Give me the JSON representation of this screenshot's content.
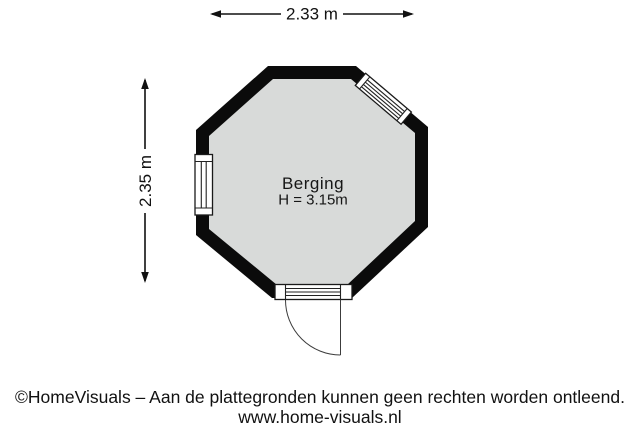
{
  "dimensions": {
    "width_label": "2.33 m",
    "height_label": "2.35 m"
  },
  "room": {
    "name": "Berging",
    "ceiling_height_label": "H = 3.15m"
  },
  "footer": {
    "line1": "©HomeVisuals – Aan de plattegronden kunnen geen rechten worden ontleend.",
    "line2": "www.home-visuals.nl"
  },
  "colors": {
    "wall": "#0b0b0b",
    "floor": "#d8dad9",
    "background": "#ffffff",
    "line": "#111111"
  },
  "icons": {
    "width_arrow": "left-right-arrow",
    "height_arrow": "up-down-arrow"
  }
}
